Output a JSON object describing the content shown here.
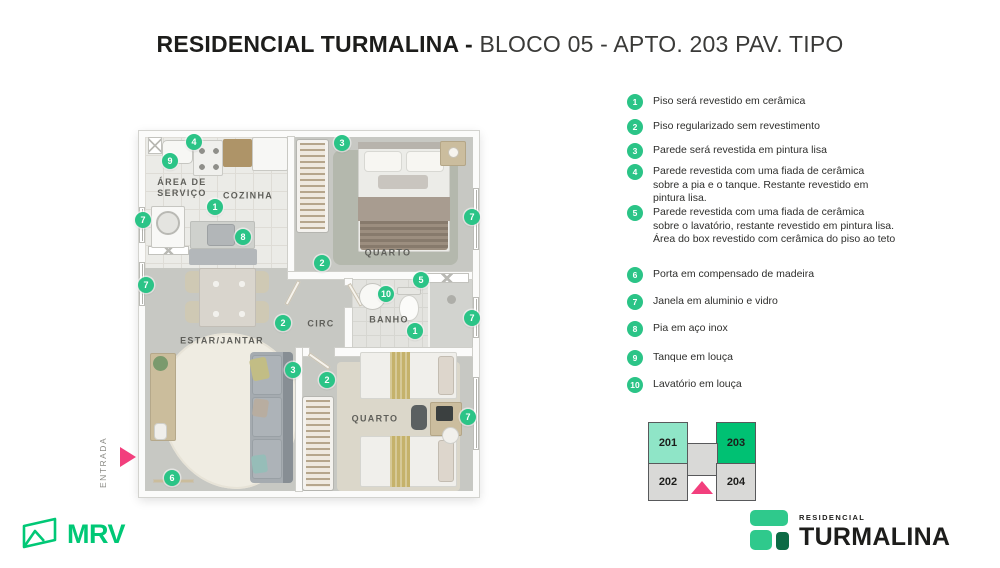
{
  "title": {
    "bold": "RESIDENCIAL TURMALINA -",
    "regular": " BLOCO 05 - APTO. 203 PAV. TIPO"
  },
  "colors": {
    "brand_green": "#00C876",
    "marker_green": "#2BC487",
    "unit_mint": "#8FE5C7",
    "unit_green": "#00C173",
    "unit_gray": "#D9D9D7",
    "accent_pink": "#F23F7D"
  },
  "legend": {
    "items": [
      {
        "num": "1",
        "text": "Piso será revestido em cerâmica"
      },
      {
        "num": "2",
        "text": "Piso regularizado sem revestimento"
      },
      {
        "num": "3",
        "text": "Parede será revestida em pintura lisa"
      },
      {
        "num": "4",
        "text": "Parede revestida com uma fiada de cerâmica\nsobre a pia e o tanque. Restante revestido em\npintura lisa."
      },
      {
        "num": "5",
        "text": "Parede revestida com uma fiada de cerâmica\nsobre o lavatório, restante revestido em pintura lisa.\nÁrea do box revestido com cerâmica do piso ao teto"
      },
      {
        "num": "6",
        "text": "Porta em compensado de madeira"
      },
      {
        "num": "7",
        "text": "Janela em aluminio e vidro"
      },
      {
        "num": "8",
        "text": "Pia em aço inox"
      },
      {
        "num": "9",
        "text": "Tanque em louça"
      },
      {
        "num": "10",
        "text": "Lavatório em louça"
      }
    ]
  },
  "plan": {
    "entrance_label": "ENTRADA",
    "labels": [
      {
        "text": "ÁREA DE\nSERVIÇO",
        "x": 37,
        "y": 51
      },
      {
        "text": "COZINHA",
        "x": 103,
        "y": 59
      },
      {
        "text": "QUARTO",
        "x": 243,
        "y": 116
      },
      {
        "text": "CIRC",
        "x": 176,
        "y": 187
      },
      {
        "text": "BANHO",
        "x": 244,
        "y": 183
      },
      {
        "text": "ESTAR/JANTAR",
        "x": 77,
        "y": 204
      },
      {
        "text": "QUARTO",
        "x": 230,
        "y": 282
      }
    ],
    "markers": [
      {
        "n": "4",
        "x": 49,
        "y": 5
      },
      {
        "n": "9",
        "x": 25,
        "y": 24
      },
      {
        "n": "3",
        "x": 197,
        "y": 6
      },
      {
        "n": "1",
        "x": 70,
        "y": 70
      },
      {
        "n": "7",
        "x": -2,
        "y": 83
      },
      {
        "n": "8",
        "x": 98,
        "y": 100
      },
      {
        "n": "7",
        "x": 327,
        "y": 80
      },
      {
        "n": "2",
        "x": 177,
        "y": 126
      },
      {
        "n": "5",
        "x": 276,
        "y": 143
      },
      {
        "n": "10",
        "x": 241,
        "y": 157
      },
      {
        "n": "7",
        "x": 1,
        "y": 148
      },
      {
        "n": "2",
        "x": 138,
        "y": 186
      },
      {
        "n": "1",
        "x": 270,
        "y": 194
      },
      {
        "n": "7",
        "x": 327,
        "y": 181
      },
      {
        "n": "3",
        "x": 148,
        "y": 233
      },
      {
        "n": "2",
        "x": 182,
        "y": 243
      },
      {
        "n": "7",
        "x": 323,
        "y": 280
      },
      {
        "n": "6",
        "x": 27,
        "y": 341
      }
    ]
  },
  "unit_map": {
    "units": [
      {
        "label": "201"
      },
      {
        "label": "202"
      },
      {
        "label": "203"
      },
      {
        "label": "204"
      }
    ]
  },
  "footer": {
    "mrv": "MRV",
    "residencial": "RESIDENCIAL",
    "turmalina": "TURMALINA"
  }
}
